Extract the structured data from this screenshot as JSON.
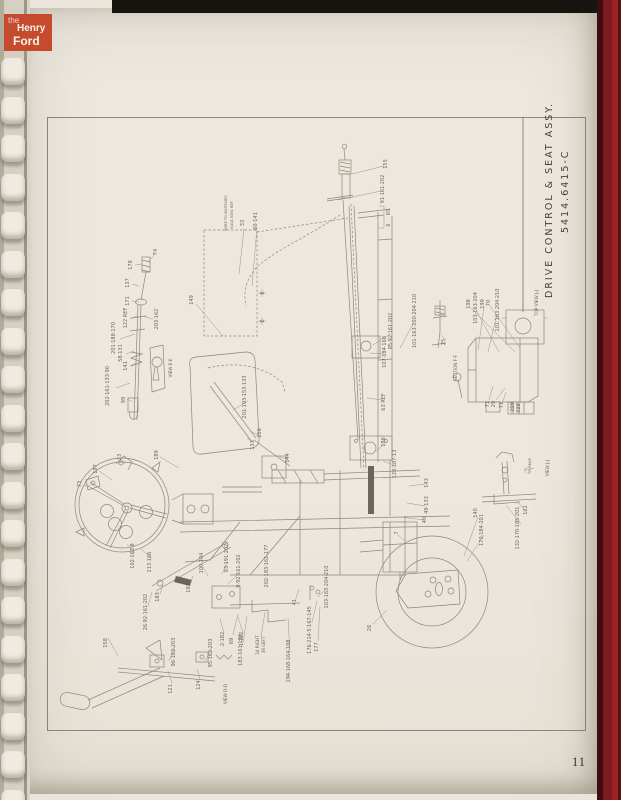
{
  "photo": {
    "logo": {
      "line1": "the",
      "line2": "Henry",
      "line3": "Ford"
    },
    "page_number": "11"
  },
  "diagram": {
    "title_line1": "DRIVE CONTROL & SEAT ASSY.",
    "title_line2": "5414.6415-C",
    "callouts": [
      {
        "t": "155",
        "x": 387,
        "y": 164
      },
      {
        "t": "91·161·202",
        "x": 384,
        "y": 189
      },
      {
        "t": "65",
        "x": 390,
        "y": 212
      },
      {
        "t": "6",
        "x": 390,
        "y": 225
      },
      {
        "t": "WIRE TO SWITCHES",
        "x": 227,
        "y": 213,
        "s": 3.6
      },
      {
        "t": "5414.5391 REF",
        "x": 233,
        "y": 215,
        "s": 3.6
      },
      {
        "t": "33",
        "x": 244,
        "y": 223
      },
      {
        "t": "60·141",
        "x": 257,
        "y": 221
      },
      {
        "t": "E",
        "x": 264,
        "y": 293
      },
      {
        "t": "E",
        "x": 264,
        "y": 321
      },
      {
        "t": "149",
        "x": 193,
        "y": 300
      },
      {
        "t": "74",
        "x": 157,
        "y": 252
      },
      {
        "t": "178",
        "x": 132,
        "y": 265
      },
      {
        "t": "137",
        "x": 129,
        "y": 283
      },
      {
        "t": "171",
        "x": 129,
        "y": 301
      },
      {
        "t": "122 REF",
        "x": 127,
        "y": 318
      },
      {
        "t": "203·162",
        "x": 158,
        "y": 319
      },
      {
        "t": "201·188·170",
        "x": 115,
        "y": 338
      },
      {
        "t": "58·131",
        "x": 122,
        "y": 353
      },
      {
        "t": "141",
        "x": 127,
        "y": 366
      },
      {
        "t": "202·161·133·90",
        "x": 109,
        "y": 386
      },
      {
        "t": "99",
        "x": 125,
        "y": 400
      },
      {
        "t": "VIEW E-E",
        "x": 172,
        "y": 368,
        "s": 4.2
      },
      {
        "t": "197",
        "x": 97,
        "y": 469
      },
      {
        "t": "23",
        "x": 121,
        "y": 457
      },
      {
        "t": "73",
        "x": 81,
        "y": 484
      },
      {
        "t": "189",
        "x": 158,
        "y": 455
      },
      {
        "t": "102·163·8",
        "x": 134,
        "y": 556
      },
      {
        "t": "213·166",
        "x": 151,
        "y": 562
      },
      {
        "t": "26·92·161·202",
        "x": 147,
        "y": 612
      },
      {
        "t": "183",
        "x": 159,
        "y": 597
      },
      {
        "t": "191",
        "x": 190,
        "y": 588
      },
      {
        "t": "100·204",
        "x": 203,
        "y": 563
      },
      {
        "t": "93·191·202",
        "x": 228,
        "y": 558
      },
      {
        "t": "9·92·161·202",
        "x": 240,
        "y": 571
      },
      {
        "t": "202·183·161·177",
        "x": 268,
        "y": 566
      },
      {
        "t": "201·193·153·133",
        "x": 246,
        "y": 397
      },
      {
        "t": "216",
        "x": 261,
        "y": 433
      },
      {
        "t": "133",
        "x": 254,
        "y": 445
      },
      {
        "t": "144",
        "x": 289,
        "y": 458
      },
      {
        "t": "85·92·161·202",
        "x": 392,
        "y": 331
      },
      {
        "t": "107·184·168",
        "x": 386,
        "y": 352
      },
      {
        "t": "63 REF",
        "x": 385,
        "y": 402
      },
      {
        "t": "101·163·200·204·210",
        "x": 416,
        "y": 321
      },
      {
        "t": "25",
        "x": 445,
        "y": 342
      },
      {
        "t": "SECTION F-F",
        "x": 457,
        "y": 368,
        "s": 4.2
      },
      {
        "t": "198",
        "x": 470,
        "y": 304
      },
      {
        "t": "103·163·204",
        "x": 477,
        "y": 308
      },
      {
        "t": "199",
        "x": 484,
        "y": 304
      },
      {
        "t": "70",
        "x": 490,
        "y": 303
      },
      {
        "t": "101·163·204·210",
        "x": 499,
        "y": 310
      },
      {
        "t": "TOP VIEW J-J",
        "x": 538,
        "y": 303,
        "s": 4.2
      },
      {
        "t": "72",
        "x": 489,
        "y": 404
      },
      {
        "t": "29",
        "x": 495,
        "y": 404
      },
      {
        "t": "71",
        "x": 503,
        "y": 405
      },
      {
        "t": "209",
        "x": 514,
        "y": 407
      },
      {
        "t": "228",
        "x": 520,
        "y": 408
      },
      {
        "t": "196",
        "x": 385,
        "y": 442
      },
      {
        "t": "128·187·13",
        "x": 396,
        "y": 464
      },
      {
        "t": "143",
        "x": 428,
        "y": 483
      },
      {
        "t": "49·133",
        "x": 428,
        "y": 505
      },
      {
        "t": "40",
        "x": 426,
        "y": 520
      },
      {
        "t": "7",
        "x": 398,
        "y": 533
      },
      {
        "t": "26",
        "x": 371,
        "y": 628
      },
      {
        "t": "140",
        "x": 477,
        "y": 513
      },
      {
        "t": "170·184·201",
        "x": 483,
        "y": 530
      },
      {
        "t": "132·170·185·201",
        "x": 519,
        "y": 528
      },
      {
        "t": "122",
        "x": 527,
        "y": 510
      },
      {
        "t": "TO REAR",
        "x": 531,
        "y": 466,
        "s": 3.6
      },
      {
        "t": "VIEW J-J",
        "x": 549,
        "y": 468,
        "s": 4.2
      },
      {
        "t": "41",
        "x": 296,
        "y": 602
      },
      {
        "t": "103·163·204·210",
        "x": 328,
        "y": 587
      },
      {
        "t": "176·214·5·167·145",
        "x": 311,
        "y": 630
      },
      {
        "t": "177",
        "x": 318,
        "y": 647
      },
      {
        "t": "194·168·164·108",
        "x": 290,
        "y": 661
      },
      {
        "t": "34 RIGHT",
        "x": 259,
        "y": 645,
        "s": 4.2
      },
      {
        "t": "36 LEFT",
        "x": 265,
        "y": 645,
        "s": 4.2
      },
      {
        "t": "183·161·133",
        "x": 242,
        "y": 650
      },
      {
        "t": "69",
        "x": 233,
        "y": 641
      },
      {
        "t": "2·182",
        "x": 224,
        "y": 639
      },
      {
        "t": "1·182",
        "x": 243,
        "y": 639
      },
      {
        "t": "158",
        "x": 107,
        "y": 643
      },
      {
        "t": "96·162·203",
        "x": 175,
        "y": 652
      },
      {
        "t": "95·162·203",
        "x": 212,
        "y": 653
      },
      {
        "t": "121",
        "x": 172,
        "y": 689
      },
      {
        "t": "124",
        "x": 200,
        "y": 685
      },
      {
        "t": "VIEW D-D",
        "x": 227,
        "y": 694,
        "s": 4.2
      }
    ]
  }
}
